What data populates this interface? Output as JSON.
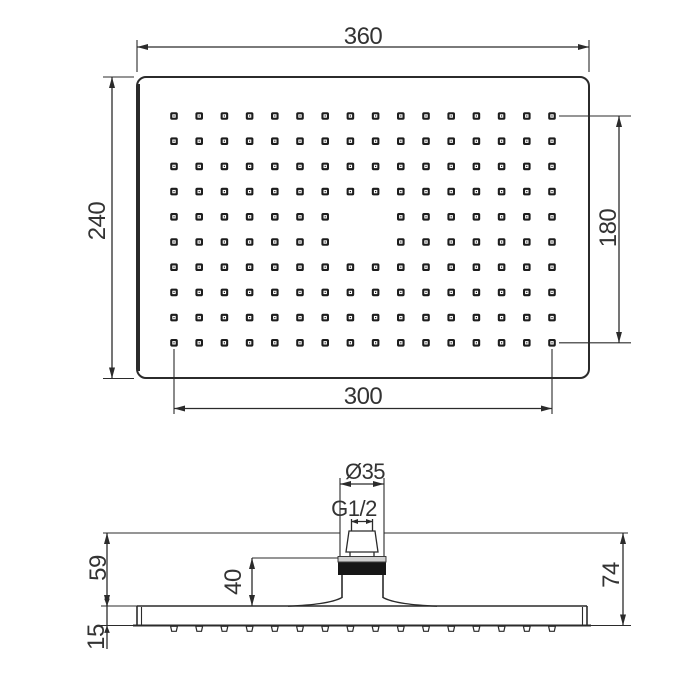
{
  "colors": {
    "line": "#2b2b2b",
    "text": "#333333",
    "nozzle_fill": "#1d1d1d",
    "band_fill": "#161616",
    "collar_fill": "#cfcfcf",
    "background": "#ffffff"
  },
  "top_view": {
    "dimensions": {
      "width": "360",
      "height": "240",
      "nozzle_field_width": "300",
      "nozzle_field_height": "180"
    },
    "grid": {
      "cols": 16,
      "rows": 10,
      "origin_x": 174,
      "origin_y": 116,
      "spacing": 25.2,
      "missing_cells": [
        [
          7,
          4
        ],
        [
          8,
          4
        ],
        [
          7,
          5
        ],
        [
          8,
          5
        ]
      ]
    }
  },
  "side_view": {
    "dimensions": {
      "connector_diameter": "Ø35",
      "thread_size": "G1/2",
      "arm_to_plate_height": "59",
      "collar_to_plate_height": "40",
      "total_height": "74",
      "plate_thickness": "15"
    },
    "nozzle_count": 16,
    "nozzle_row_y": 625.5
  }
}
